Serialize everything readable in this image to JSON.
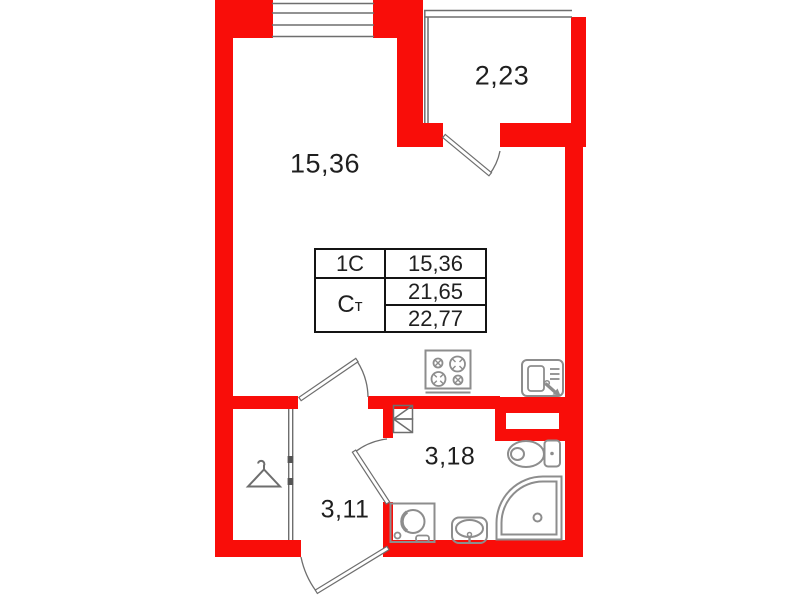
{
  "plan": {
    "type": "apartment-floor-plan-studio",
    "rooms": {
      "living_area": "15,36",
      "balcony_area": "2,23",
      "bathroom_area": "3,18",
      "hallway_area": "3,11"
    },
    "info_table": {
      "row1_key": "1С",
      "row1_value": "15,36",
      "row2_key_main": "С",
      "row2_key_sub": "т",
      "row2_value": "21,65",
      "row3_value": "22,77"
    },
    "colors": {
      "wall": "#f90d09",
      "thin_line": "#6e6e6e",
      "fixture": "#8d8d8d",
      "text": "#1f1f1f",
      "table_border": "#141414"
    },
    "icons": [
      "stove-icon",
      "kitchen-cabinet-sink-icon",
      "toilet-icon",
      "shower-tray-icon",
      "washbasin-icon",
      "washing-machine-icon",
      "hanger-icon",
      "vent-shaft-icon"
    ]
  }
}
